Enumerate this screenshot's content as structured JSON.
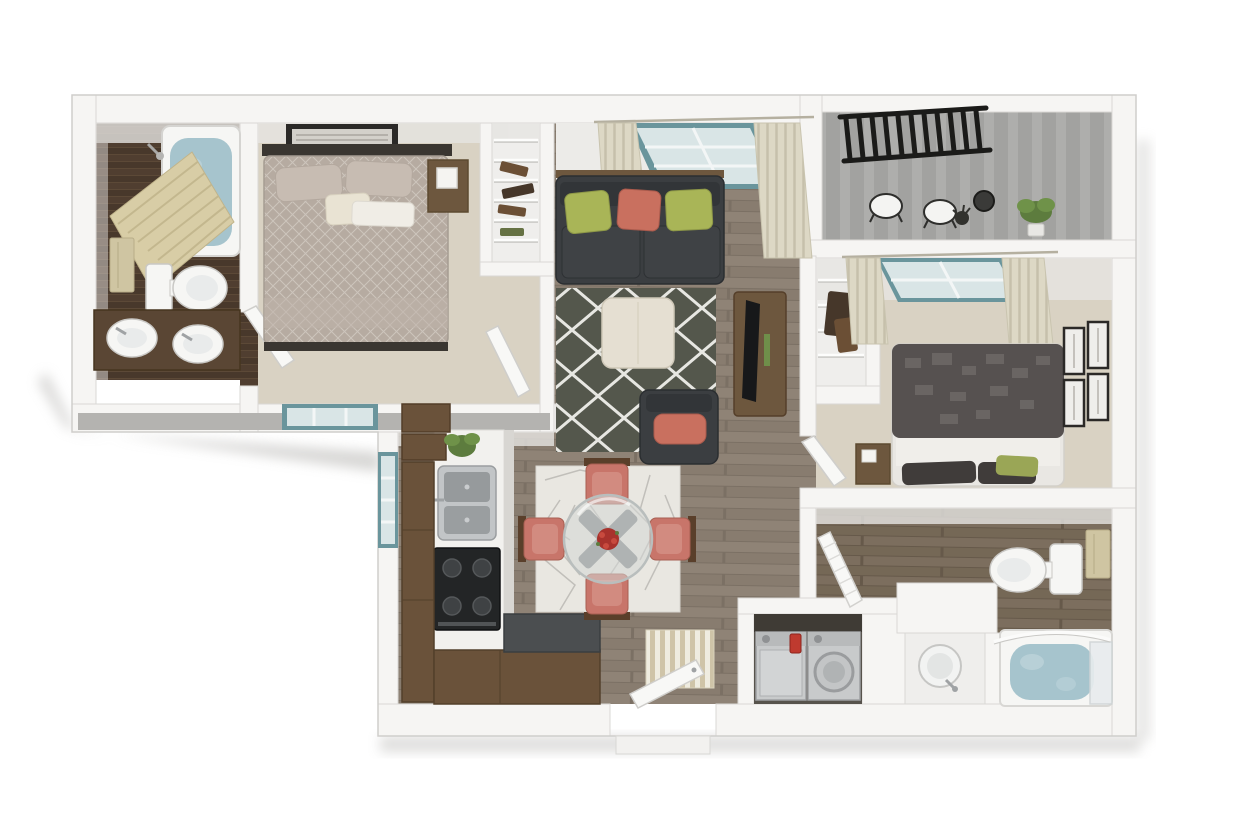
{
  "canvas": {
    "width": 1240,
    "height": 830
  },
  "scene": {
    "type": "3d-floor-plan-rendering",
    "description": "Dollhouse-style 3D floor plan of a two-bedroom, two-bathroom apartment with balcony, open living/dining/kitchen area, laundry closet and entry",
    "rooms": [
      {
        "name": "Bathroom 1",
        "floor": "dark wood",
        "items": [
          "bathtub with water",
          "striped shower curtain",
          "shower head",
          "toilet",
          "double-sink wood vanity",
          "tan towel on rack",
          "door"
        ]
      },
      {
        "name": "Bedroom 1",
        "floor": "beige carpet",
        "items": [
          "metal-frame bed with patterned duvet",
          "two taupe pillows",
          "cream accent pillow",
          "wall art frame",
          "nightstand with lamp",
          "exterior window",
          "linen closet with wire shelves",
          "door"
        ]
      },
      {
        "name": "Living Room",
        "floor": "gray-brown wood plank",
        "items": [
          "charcoal sofa with wood trim",
          "green pillow",
          "coral pillow",
          "green pillow",
          "lattice area rug",
          "cream ottoman",
          "media console with TV",
          "accent chair with coral cushion",
          "window with cream curtains"
        ]
      },
      {
        "name": "Balcony",
        "floor": "striped concrete",
        "items": [
          "black metal railing",
          "two white bistro chairs",
          "wire bistro table",
          "dark plant stand",
          "green potted plant"
        ]
      },
      {
        "name": "Bedroom 2",
        "floor": "beige carpet",
        "items": [
          "bed with charcoal block-pattern duvet",
          "white sheet",
          "dark pillows",
          "green accent pillow",
          "nightstand",
          "four gallery frames on wall",
          "window with cream curtains",
          "walk-in closet with wire shelves",
          "door"
        ]
      },
      {
        "name": "Bathroom 2",
        "floor": "wood plank",
        "items": [
          "toilet",
          "tan towel on ring",
          "pedestal sink",
          "bathtub with water",
          "curved shower rod",
          "glass panel",
          "louvered door"
        ]
      },
      {
        "name": "Kitchen",
        "floor": "wood plank",
        "items": [
          "upper cabinets",
          "potted plant",
          "white counter",
          "double stainless sink with faucet",
          "black range with four burners",
          "brown base cabinets",
          "dark-top peninsula",
          "side window"
        ]
      },
      {
        "name": "Dining Area",
        "floor": "wood plank",
        "items": [
          "crackle-pattern area rug",
          "round glass table with X base",
          "red floral centerpiece",
          "four coral dining chairs"
        ]
      },
      {
        "name": "Laundry Closet",
        "items": [
          "washer with red detergent bottle",
          "dryer with round door"
        ]
      },
      {
        "name": "Entry",
        "items": [
          "striped door mat",
          "open front door",
          "threshold step"
        ]
      }
    ]
  },
  "colors": {
    "page_bg": "#ffffff",
    "wall": "#f6f5f3",
    "wall_edge": "#d2d1ce",
    "wall_face_shade": "#e6e5e2",
    "wall_dark_face": "#b4b3b0",
    "shadow": "#b7b6b3",
    "wood_a": "#8f8376",
    "wood_b": "#887c6f",
    "wood_line": "#7b7064",
    "wood_dark_a": "#7c6e5e",
    "wood_dark_b": "#756856",
    "bath1_floor_a": "#503e30",
    "bath1_floor_b": "#48382b",
    "carpet": "#d9d2c3",
    "balcony_floor": "#a2a2a0",
    "balcony_stripe": "#aeaeac",
    "railing": "#1b1b19",
    "window_teal": "#6a959c",
    "window_glass": "#d9e5e6",
    "mullion": "#f3f6f6",
    "curtain": "#ddd8c5",
    "curtain_stripe": "#c6c0ab",
    "shower_curtain": "#d8cda6",
    "shower_stripe": "#c3b78e",
    "towel": "#cfc5a2",
    "porcelain": "#f6f6f4",
    "porcelain_edge": "#c9c8c5",
    "basin": "#e9ebeb",
    "water": "#a6c4cd",
    "vanity_wood": "#5a4634",
    "sofa": "#3b3e41",
    "sofa_dark": "#323538",
    "pillow_green": "#a9b557",
    "pillow_coral": "#c9705f",
    "rug_living": "#54574c",
    "rug_lattice": "#e7e7e2",
    "ottoman": "#e5dfd2",
    "furniture_wood": "#6d573e",
    "furniture_wood_dark": "#553f2a",
    "tv": "#17181a",
    "bed1_duvet": "#b6aba1",
    "pillow_taupe": "#c7bcb2",
    "pillow_cream": "#e9e3d3",
    "bed2_duvet": "#565150",
    "bed2_block": "#6d6866",
    "sheet": "#f0eeea",
    "bed2_pillow": "#403c3a",
    "bed2_green": "#9aa656",
    "frame_dark": "#2b2927",
    "frame_mat": "#efeeeb",
    "cabinet": "#6a523a",
    "cabinet_dark": "#53402b",
    "counter": "#f2f1ee",
    "steel": "#c2c5c7",
    "steel_dark": "#969a9c",
    "range": "#232526",
    "burner": "#3f4244",
    "peninsula_top": "#4b4e50",
    "appliance": "#c8cacb",
    "appliance_panel": "#b8babb",
    "detergent_red": "#bf3a2f",
    "laundry_shadow": "#57534c",
    "dining_rug": "#e9e7e1",
    "dining_rug_line": "#bdbbb6",
    "chair_coral": "#c8756a",
    "chair_coral_light": "#d28b80",
    "chair_wood": "#5a3f2a",
    "glass_table": "#d3d7d6",
    "table_base": "#84888a",
    "flowers_red": "#a8322c",
    "plant_green": "#5d7c3e",
    "plant_green_light": "#6f9249",
    "door_leaf": "#f8f8f6",
    "closet_bg": "#efeeec",
    "wire_shelf": "#fdfdfc",
    "clothes_brown": "#6b4f35",
    "clothes_dark": "#46372a"
  }
}
